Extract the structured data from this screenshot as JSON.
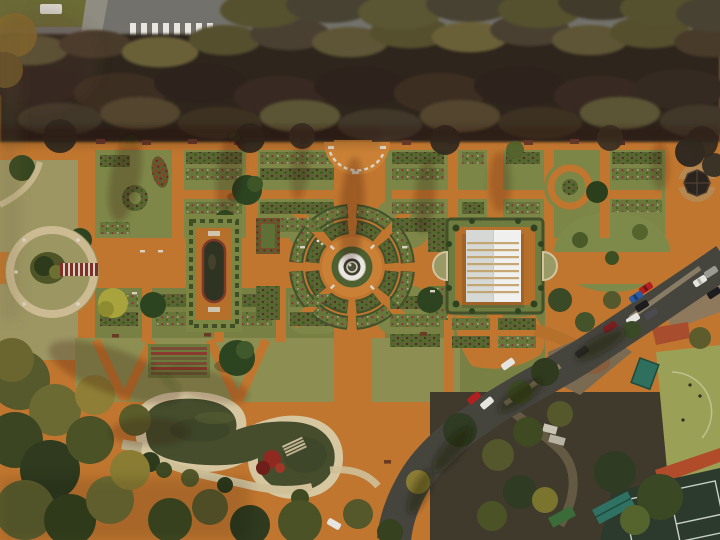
{
  "meta": {
    "description": "Aerial top-down drone photograph of a large formal rose garden in winter: orange gravel paths, geometric parterres, a central fountain, a white-roofed pergola pavilion, a reflecting pool, a circular pergola court, a two-lobed pond, a tree-lined avenue at top, a curved road with parked cars and sports courts at right",
    "width": 720,
    "height": 540
  },
  "scene": {
    "setting": "formal rose garden seen from directly above",
    "landmarks": [
      {
        "name": "tree-lined avenue with pedestrian crossing",
        "position": "top"
      },
      {
        "name": "bare winter tree canopy band",
        "position": "upper"
      },
      {
        "name": "semicircular terrace with white balustrade",
        "position": "top-center"
      },
      {
        "name": "central circular fountain with ring beds",
        "position": "center"
      },
      {
        "name": "white-roofed pergola pavilion in square parterre",
        "position": "center-right"
      },
      {
        "name": "rectangular reflecting pool with hedge frame",
        "position": "center-left"
      },
      {
        "name": "circular pergola court with red trellis walk",
        "position": "left"
      },
      {
        "name": "dark-roofed gazebo on circular plaza",
        "position": "upper-right"
      },
      {
        "name": "two-lobed pond with sandy banks and footbridge",
        "position": "bottom-center-left"
      },
      {
        "name": "curved road with parked cars",
        "position": "right"
      },
      {
        "name": "sports field, clay strip and dark green court",
        "position": "bottom-right"
      },
      {
        "name": "dense woodland",
        "position": "bottom-left"
      }
    ]
  },
  "palette": {
    "ground": "#c0762f",
    "ground_bright": "#cf8a3e",
    "road_top": "#72716b",
    "tree_band": "#2f261e",
    "grass": "#7f8748",
    "grass_dry": "#9d9663",
    "path_pale": "#ccbb92",
    "water": "#454d2d",
    "pond_border": "#d6c7a0",
    "pavilion_roof_left": "#d6d8d5",
    "pavilion_roof_right": "#f0f1ee",
    "road_side": "#45453d",
    "field": "#9aa156",
    "court": "#2c3a2e",
    "clay": "#b04c2a",
    "canopy_teal": "#2f6f5e",
    "pergola_red": "#7c3126",
    "flower_red": "#a8322a"
  }
}
